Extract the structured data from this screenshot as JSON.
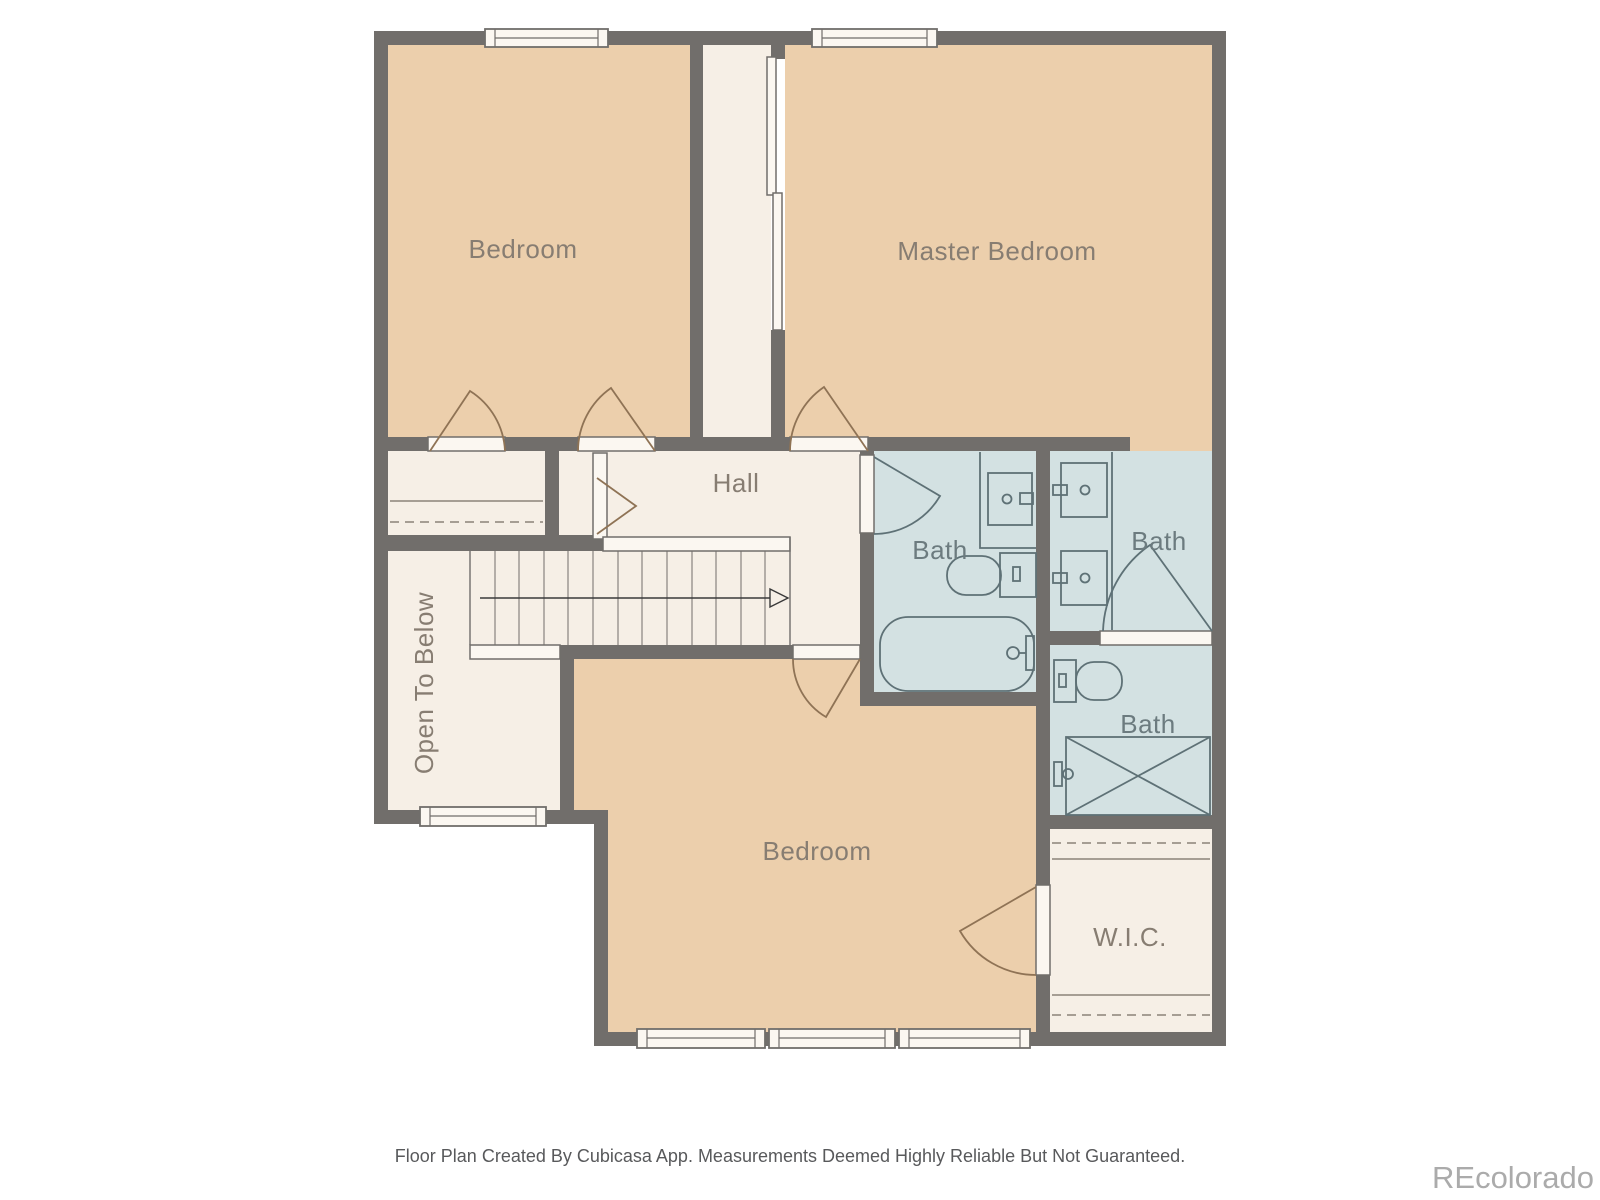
{
  "floor_plan": {
    "rooms": {
      "bedroom_top_left": {
        "label": "Bedroom"
      },
      "master_bedroom": {
        "label": "Master Bedroom"
      },
      "hall": {
        "label": "Hall"
      },
      "bath_middle": {
        "label": "Bath"
      },
      "bath_top_right": {
        "label": "Bath"
      },
      "bath_lower_right": {
        "label": "Bath"
      },
      "bedroom_bottom": {
        "label": "Bedroom"
      },
      "open_to_below": {
        "label": "Open To Below"
      },
      "walk_in_closet": {
        "label": "W.I.C."
      }
    },
    "colors": {
      "wall": "#716E6B",
      "bedroom_fill": "#ECCFAC",
      "hall_fill": "#F6EFE6",
      "bath_fill": "#D3E1E2",
      "sill_fill": "#FBF7F1",
      "door_arc_wood": "#8F7355",
      "bath_fixture_line": "#5E7176",
      "room_label_text": "#877D72",
      "bath_label_text": "#6C7B7F"
    }
  },
  "footer": {
    "disclaimer": "Floor Plan Created By Cubicasa App. Measurements Deemed Highly Reliable But Not Guaranteed."
  },
  "watermark": {
    "text": "REcolorado"
  }
}
